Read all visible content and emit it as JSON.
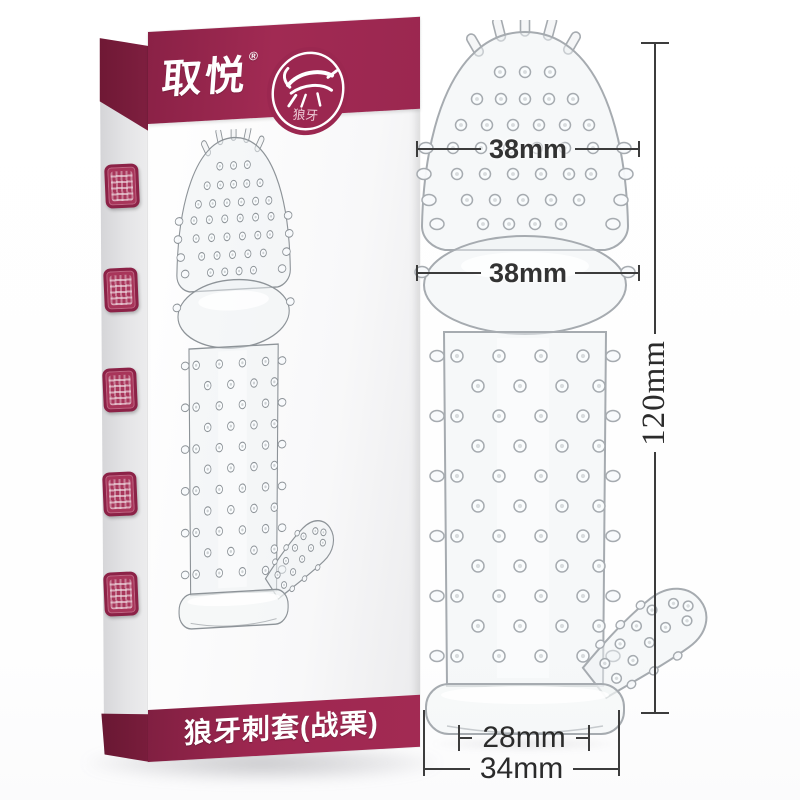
{
  "page": {
    "background": "#ffffff"
  },
  "box": {
    "brand": "取悦",
    "brand_mark": "®",
    "badge": {
      "icon": "wolf-icon",
      "label": "狼牙"
    },
    "title": "狼牙刺套(战栗)",
    "band_color": "#9e2750",
    "seal_color": "#a8355a"
  },
  "dimensions": {
    "head_width": "38mm",
    "bulb_width": "38mm",
    "total_length": "120mm",
    "inner_diameter": "28mm",
    "base_width": "34mm"
  }
}
